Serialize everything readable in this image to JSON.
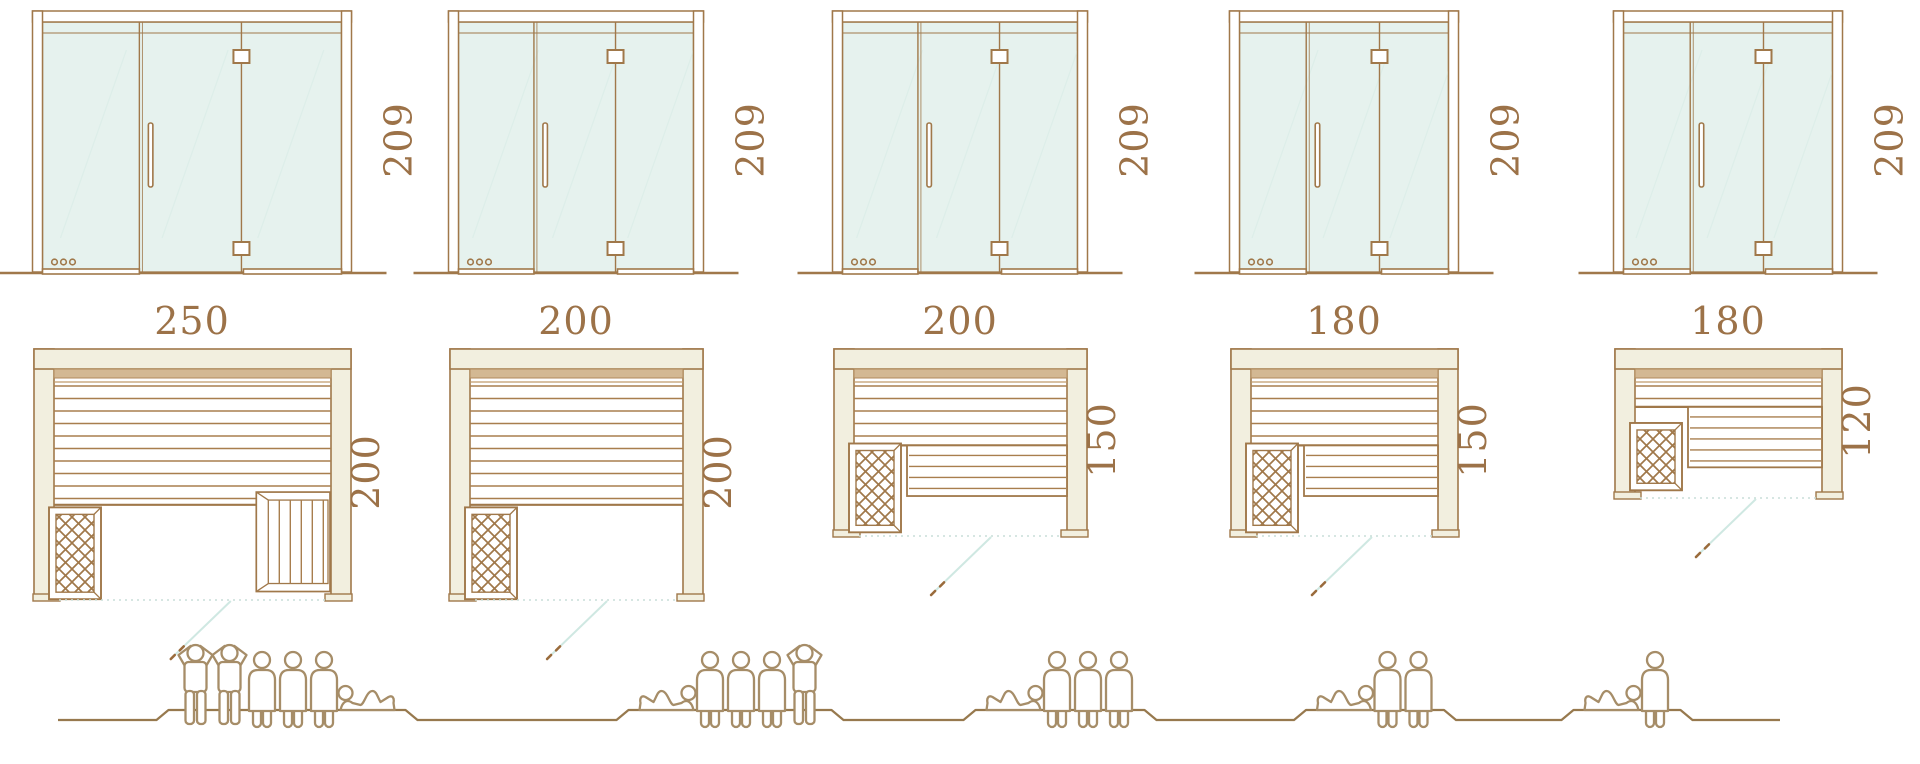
{
  "models": [
    {
      "door_height": "209",
      "width": "250",
      "depth": "200",
      "capacity": 6,
      "people": [
        "standing",
        "standing",
        "sitting",
        "sitting",
        "sitting",
        "lying"
      ]
    },
    {
      "door_height": "209",
      "width": "200",
      "depth": "200",
      "capacity": 5,
      "people": [
        "lying",
        "sitting",
        "sitting",
        "sitting",
        "standing"
      ]
    },
    {
      "door_height": "209",
      "width": "200",
      "depth": "150",
      "capacity": 4,
      "people": [
        "lying",
        "sitting",
        "sitting",
        "sitting"
      ]
    },
    {
      "door_height": "209",
      "width": "180",
      "depth": "150",
      "capacity": 3,
      "people": [
        "lying",
        "sitting",
        "sitting"
      ]
    },
    {
      "door_height": "209",
      "width": "180",
      "depth": "120",
      "capacity": 2,
      "people": [
        "lying",
        "sitting"
      ]
    }
  ],
  "colors": {
    "outline": "#a0784a",
    "frame_fill": "#f2efdf",
    "glass": "#e6f2ee",
    "glass_reflection": "#ddeee9",
    "wood_band": "#d3b893",
    "slat_line": "#a87e4e",
    "swing_line": "#cfe8e2",
    "threshold_dotted": "#c9ddd8",
    "swing_dash": "#9a6b3c",
    "figure": "#a68d68",
    "ground": "#97794e",
    "dimension_text": "#9c7248"
  },
  "icons": [
    "glass-door-elevation",
    "hinge-icon",
    "door-handle",
    "vent-hole-icon",
    "heater-icon",
    "side-bench",
    "lower-bench",
    "door-swing-line",
    "standing-person-icon",
    "sitting-person-icon",
    "lying-person-icon",
    "ground-line"
  ]
}
